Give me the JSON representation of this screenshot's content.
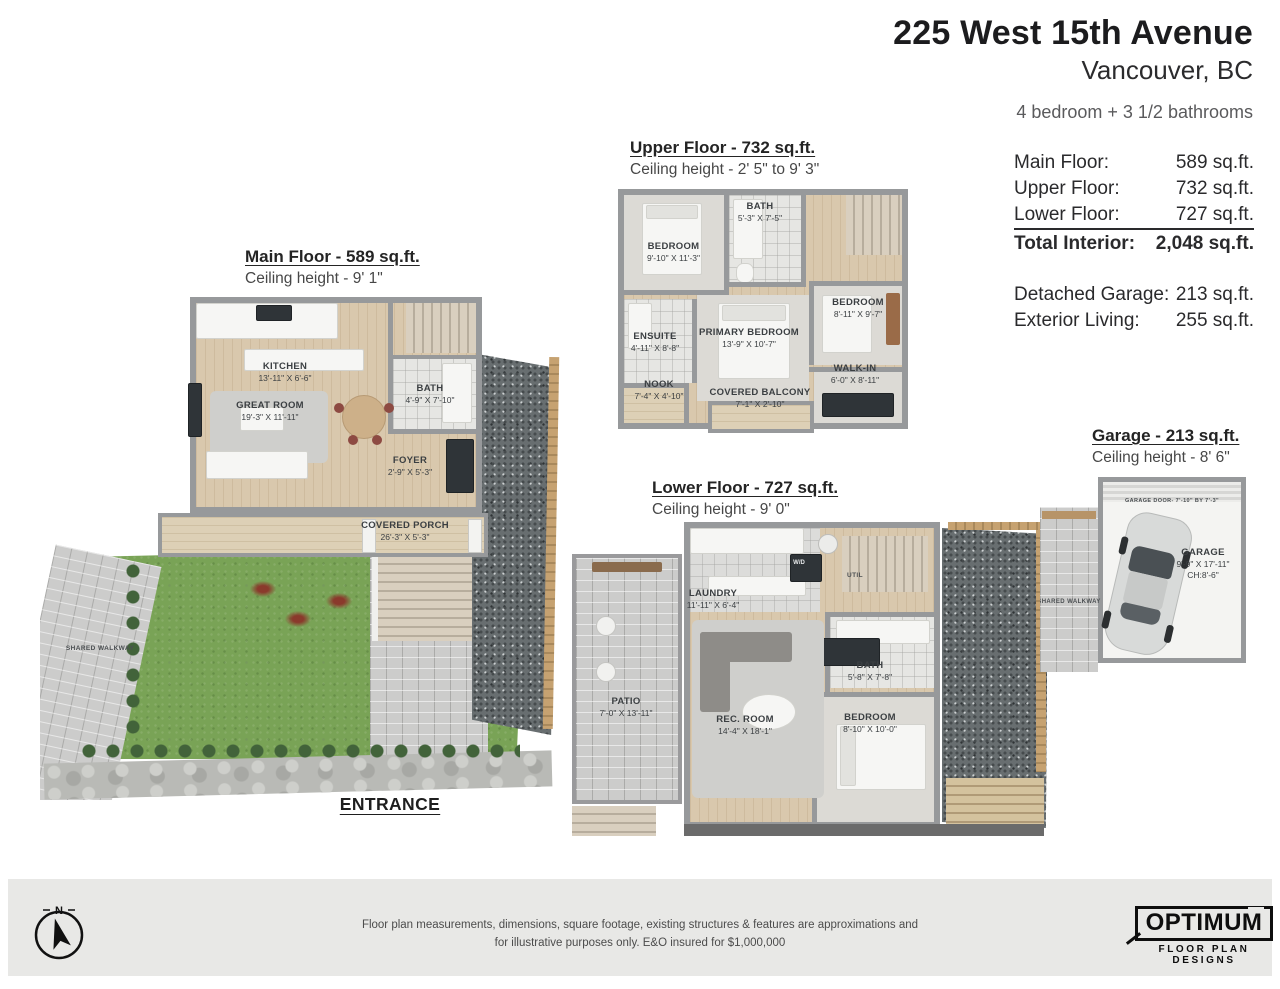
{
  "header": {
    "address": "225 West 15th Avenue",
    "city": "Vancouver, BC",
    "bed_bath": "4 bedroom + 3 1/2 bathrooms"
  },
  "area_table": {
    "rows": [
      {
        "label": "Main Floor:",
        "value": "589 sq.ft."
      },
      {
        "label": "Upper Floor:",
        "value": "732 sq.ft."
      },
      {
        "label": "Lower Floor:",
        "value": "727 sq.ft."
      }
    ],
    "total_label": "Total Interior:",
    "total_value": "2,048 sq.ft.",
    "extra_rows": [
      {
        "label": "Detached Garage:",
        "value": "213 sq.ft."
      },
      {
        "label": "Exterior Living:",
        "value": "255 sq.ft."
      }
    ]
  },
  "plans": {
    "main": {
      "title": "Main Floor - 589 sq.ft.",
      "ceiling": "Ceiling height - 9' 1\"",
      "rooms": [
        {
          "name": "KITCHEN",
          "dims": "13'-11\" X 6'-6\""
        },
        {
          "name": "GREAT ROOM",
          "dims": "19'-3\" X 11'-11\""
        },
        {
          "name": "BATH",
          "dims": "4'-9\" X 7'-10\""
        },
        {
          "name": "FOYER",
          "dims": "2'-9\" X 5'-3\""
        },
        {
          "name": "COVERED PORCH",
          "dims": "26'-3\" X 5'-3\""
        }
      ],
      "walkway_label": "SHARED WALKWAY",
      "entrance_label": "ENTRANCE"
    },
    "upper": {
      "title": "Upper Floor - 732 sq.ft.",
      "ceiling": "Ceiling height - 2' 5\" to 9' 3\"",
      "rooms": [
        {
          "name": "BEDROOM",
          "dims": "9'-10\" X 11'-3\""
        },
        {
          "name": "BATH",
          "dims": "5'-3\" X 7'-5\""
        },
        {
          "name": "BEDROOM",
          "dims": "8'-11\" X 9'-7\""
        },
        {
          "name": "ENSUITE",
          "dims": "4'-11\" X 8'-8\""
        },
        {
          "name": "PRIMARY BEDROOM",
          "dims": "13'-9\" X 10'-7\""
        },
        {
          "name": "NOOK",
          "dims": "7'-4\" X 4'-10\""
        },
        {
          "name": "COVERED BALCONY",
          "dims": "7'-1\" X 2'-10\""
        },
        {
          "name": "WALK-IN",
          "dims": "6'-0\" X 8'-11\""
        }
      ]
    },
    "lower": {
      "title": "Lower Floor - 727 sq.ft.",
      "ceiling": "Ceiling height - 9' 0\"",
      "rooms": [
        {
          "name": "LAUNDRY",
          "dims": "11'-11\" X 6'-4\""
        },
        {
          "name": "BATH",
          "dims": "5'-8\" X 7'-8\""
        },
        {
          "name": "REC. ROOM",
          "dims": "14'-4\" X 18'-1\""
        },
        {
          "name": "BEDROOM",
          "dims": "8'-10\" X 10'-0\""
        },
        {
          "name": "PATIO",
          "dims": "7'-0\" X 13'-11\""
        }
      ],
      "util_label": "UTIL",
      "wd_label": "W/D"
    },
    "garage": {
      "title": "Garage - 213 sq.ft.",
      "ceiling": "Ceiling height - 8' 6\"",
      "room_name": "GARAGE",
      "room_dims": "9'-9\" X 17'-11\"",
      "room_ch": "CH:8'-6\"",
      "door_label": "GARAGE DOOR- 7'-10\" BY 7'-3\"",
      "walkway_label": "SHARED WALKWAY"
    }
  },
  "footer": {
    "compass_n": "N",
    "disclaimer_line1": "Floor plan measurements, dimensions, square footage, existing structures & features are approximations and",
    "disclaimer_line2": "for illustrative purposes only.  E&O insured for $1,000,000",
    "logo_main": "OPTIMUM",
    "logo_sub": "FLOOR PLAN DESIGNS"
  },
  "colors": {
    "grass": "#79a356",
    "wood_floor": "#d9c8ad",
    "wall_gray": "#97999b",
    "gravel": "#686e70",
    "paver": "#cccccb",
    "fence": "#c6a271",
    "footer_bar": "#e8e8e6",
    "text_dark": "#1c1c1e"
  }
}
